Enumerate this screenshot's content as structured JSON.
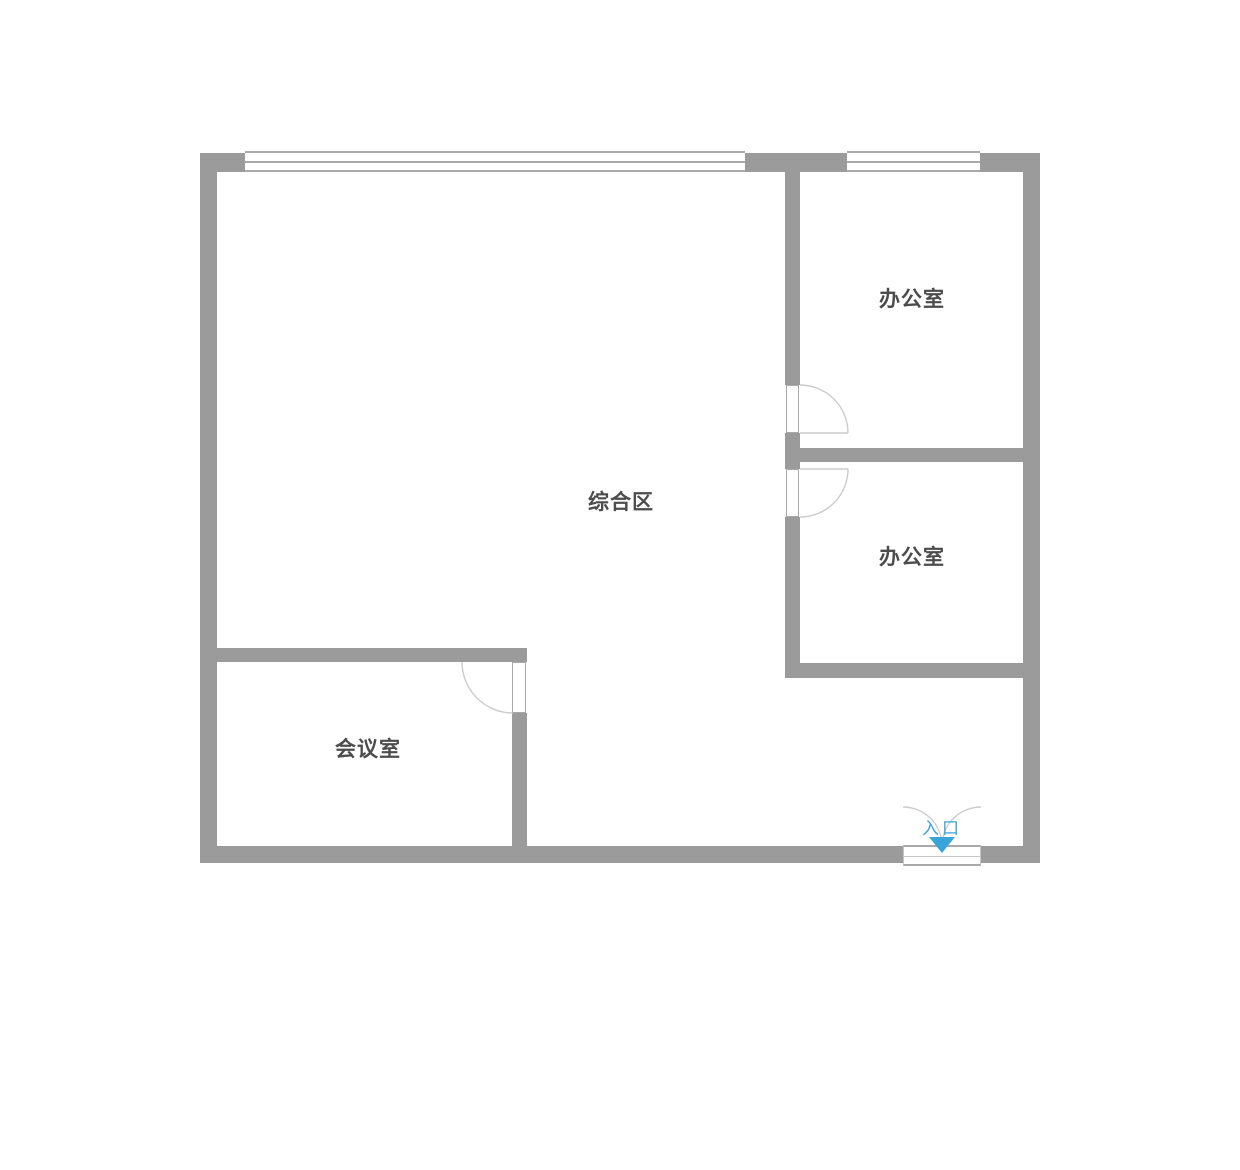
{
  "plan": {
    "rooms": [
      {
        "id": "comprehensive-area",
        "label": "综合区"
      },
      {
        "id": "office-upper",
        "label": "办公室"
      },
      {
        "id": "office-lower",
        "label": "办公室"
      },
      {
        "id": "meeting-room",
        "label": "会议室"
      }
    ],
    "entrance": {
      "label": "入口",
      "arrow_icon": "triangle-down-icon"
    },
    "colors": {
      "background": "#ffffff",
      "wall": "#9b9b9b",
      "opening_line": "#a9a9a9",
      "arc_line": "#cbcbcb",
      "label_text": "#4c4c4c",
      "accent": "#38a5da"
    }
  }
}
